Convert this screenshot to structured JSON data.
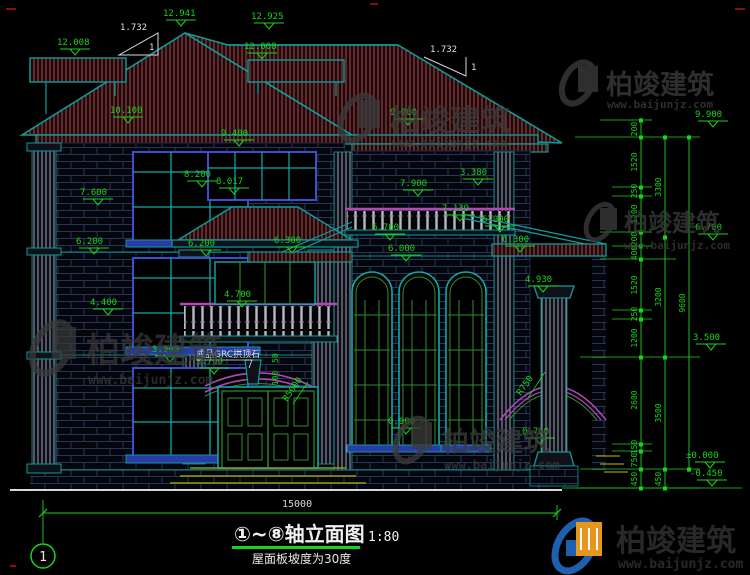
{
  "drawing": {
    "axis_bubble": "1",
    "title": "①~⑧轴立面图",
    "scale": "1:80",
    "subtitle": "屋面板坡度为30度",
    "total_width_dim": "15000",
    "grc_note": "成品GRC拱顶石",
    "slope_run": "1.732",
    "slope_rise": "1",
    "radius_entry_arch": "R5000",
    "radius_porch_arch": "R750",
    "arch_trim_dim_top": "50",
    "arch_trim_dim_bottom": "100"
  },
  "lv": {
    "peak": "12.941",
    "ridge_rear": "12.925",
    "ridge_band_l": "12.008",
    "ridge_band_r": "12.008",
    "main_eave": "10.100",
    "eave_r": "9.900",
    "win3c_top": "9.400",
    "canopy_hi": "8.200",
    "canopy_lo": "8.017",
    "win3l_sill": "7.600",
    "bal3_top": "7.900",
    "bal3_h": "3.380",
    "bal3_rail": "7.139",
    "porch_l_ridge": "6.700",
    "porch_l_beam": "6.000",
    "porch_l_eave": "6.300",
    "porch_r_ridge": "6.900",
    "porch_r_eave": "6.300",
    "win2l_top": "6.200",
    "win2c_top": "6.200",
    "win2l_sill": "4.400",
    "bal2_rail": "4.700",
    "cap_top": "4.930",
    "win1l_top": "3.000",
    "arch_spring": "2.700",
    "win1r_sill": "0.900",
    "porch_floor": "0.750"
  },
  "right_dims": {
    "inner": [
      "200",
      "1520",
      "250",
      "1200",
      "200",
      "400",
      "1520",
      "250",
      "1200",
      "2600",
      "150",
      "750",
      "450"
    ],
    "mid": [
      "3300",
      "3200",
      "3500",
      "450"
    ],
    "outer": [
      "9600"
    ],
    "levels": {
      "top": "9.900",
      "upper": "6.700",
      "mid": "3.500",
      "zero": "±0.000",
      "ground": "-0.450"
    }
  },
  "watermark": {
    "brand": "柏竣建筑",
    "url": "www.baijunjz.com"
  },
  "colors": {
    "dim_green": "#19d419",
    "teal": "#0d9b9b",
    "magenta": "#b447b4",
    "frame_blue": "#3d4fd0",
    "roof_red": "#8f3f3f",
    "white": "#e0e0e0"
  }
}
